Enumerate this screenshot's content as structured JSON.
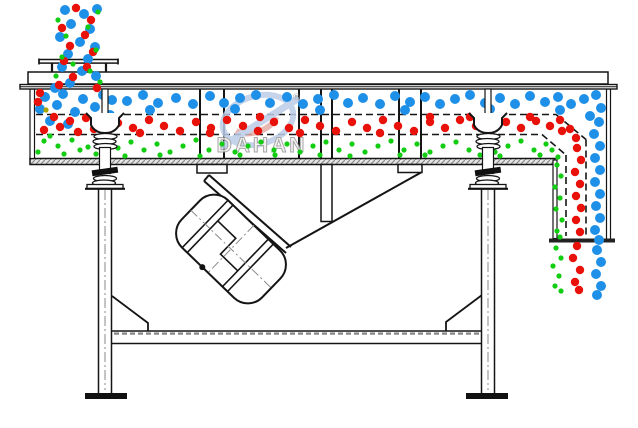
{
  "watermark": {
    "brand": "DAHAN",
    "registered": "®"
  },
  "particles": {
    "colors": {
      "coarse_blue": "#1f90e8",
      "medium_red": "#e8120b",
      "fine_green": "#12cd12",
      "stray_olive": "#a8a400"
    },
    "radii": {
      "coarse_blue": 5,
      "medium_red": 4.2,
      "fine_green": 2.6,
      "stray_olive": 2.6
    },
    "groups": {
      "coarse_blue": [
        [
          65,
          10
        ],
        [
          84,
          14
        ],
        [
          97,
          9
        ],
        [
          71,
          24
        ],
        [
          90,
          29
        ],
        [
          60,
          37
        ],
        [
          80,
          42
        ],
        [
          95,
          47
        ],
        [
          68,
          54
        ],
        [
          88,
          59
        ],
        [
          62,
          67
        ],
        [
          82,
          71
        ],
        [
          96,
          76
        ],
        [
          70,
          83
        ],
        [
          55,
          88
        ],
        [
          45,
          97
        ],
        [
          63,
          94
        ],
        [
          83,
          99
        ],
        [
          103,
          95
        ],
        [
          40,
          109
        ],
        [
          57,
          105
        ],
        [
          75,
          112
        ],
        [
          95,
          107
        ],
        [
          112,
          100
        ],
        [
          50,
          121
        ],
        [
          68,
          124
        ],
        [
          110,
          115
        ],
        [
          127,
          101
        ],
        [
          143,
          95
        ],
        [
          158,
          103
        ],
        [
          176,
          98
        ],
        [
          193,
          104
        ],
        [
          210,
          96
        ],
        [
          224,
          103
        ],
        [
          240,
          98
        ],
        [
          256,
          95
        ],
        [
          270,
          103
        ],
        [
          287,
          97
        ],
        [
          303,
          104
        ],
        [
          318,
          99
        ],
        [
          334,
          95
        ],
        [
          348,
          103
        ],
        [
          363,
          98
        ],
        [
          380,
          104
        ],
        [
          395,
          96
        ],
        [
          410,
          102
        ],
        [
          425,
          97
        ],
        [
          440,
          104
        ],
        [
          455,
          99
        ],
        [
          470,
          95
        ],
        [
          485,
          103
        ],
        [
          500,
          98
        ],
        [
          515,
          104
        ],
        [
          530,
          96
        ],
        [
          545,
          102
        ],
        [
          558,
          97
        ],
        [
          571,
          104
        ],
        [
          584,
          99
        ],
        [
          596,
          95
        ],
        [
          150,
          110
        ],
        [
          235,
          109
        ],
        [
          320,
          110
        ],
        [
          405,
          110
        ],
        [
          490,
          109
        ],
        [
          560,
          110
        ],
        [
          601,
          108
        ],
        [
          590,
          116
        ],
        [
          599,
          122
        ],
        [
          594,
          134
        ],
        [
          600,
          146
        ],
        [
          595,
          158
        ],
        [
          600,
          170
        ],
        [
          595,
          182
        ],
        [
          600,
          194
        ],
        [
          596,
          206
        ],
        [
          600,
          218
        ],
        [
          595,
          230
        ],
        [
          599,
          240
        ],
        [
          597,
          250
        ],
        [
          601,
          262
        ],
        [
          596,
          274
        ],
        [
          601,
          286
        ],
        [
          597,
          295
        ]
      ],
      "medium_red": [
        [
          76,
          8
        ],
        [
          91,
          20
        ],
        [
          62,
          28
        ],
        [
          85,
          35
        ],
        [
          70,
          46
        ],
        [
          93,
          52
        ],
        [
          64,
          61
        ],
        [
          87,
          67
        ],
        [
          73,
          77
        ],
        [
          59,
          85
        ],
        [
          97,
          88
        ],
        [
          38,
          102
        ],
        [
          54,
          117
        ],
        [
          70,
          121
        ],
        [
          86,
          118
        ],
        [
          102,
          124
        ],
        [
          44,
          130
        ],
        [
          60,
          127
        ],
        [
          78,
          132
        ],
        [
          94,
          129
        ],
        [
          108,
          131
        ],
        [
          40,
          93
        ],
        [
          118,
          123
        ],
        [
          133,
          128
        ],
        [
          149,
          120
        ],
        [
          164,
          126
        ],
        [
          180,
          131
        ],
        [
          196,
          122
        ],
        [
          211,
          128
        ],
        [
          227,
          120
        ],
        [
          243,
          126
        ],
        [
          258,
          131
        ],
        [
          274,
          122
        ],
        [
          289,
          128
        ],
        [
          305,
          120
        ],
        [
          320,
          126
        ],
        [
          336,
          131
        ],
        [
          352,
          122
        ],
        [
          367,
          128
        ],
        [
          383,
          120
        ],
        [
          398,
          126
        ],
        [
          414,
          131
        ],
        [
          430,
          122
        ],
        [
          445,
          128
        ],
        [
          460,
          120
        ],
        [
          476,
          126
        ],
        [
          491,
          131
        ],
        [
          506,
          122
        ],
        [
          521,
          128
        ],
        [
          536,
          121
        ],
        [
          550,
          126
        ],
        [
          562,
          131
        ],
        [
          140,
          133
        ],
        [
          260,
          117
        ],
        [
          380,
          133
        ],
        [
          300,
          133
        ],
        [
          470,
          117
        ],
        [
          210,
          133
        ],
        [
          430,
          117
        ],
        [
          530,
          117
        ],
        [
          560,
          120
        ],
        [
          570,
          129
        ],
        [
          576,
          138
        ],
        [
          577,
          148
        ],
        [
          581,
          160
        ],
        [
          575,
          172
        ],
        [
          580,
          184
        ],
        [
          576,
          196
        ],
        [
          581,
          208
        ],
        [
          576,
          220
        ],
        [
          580,
          232
        ],
        [
          577,
          246
        ],
        [
          573,
          258
        ],
        [
          580,
          270
        ],
        [
          575,
          282
        ],
        [
          579,
          290
        ]
      ],
      "fine_green": [
        [
          98,
          12
        ],
        [
          58,
          20
        ],
        [
          88,
          27
        ],
        [
          66,
          36
        ],
        [
          96,
          50
        ],
        [
          62,
          57
        ],
        [
          90,
          71
        ],
        [
          73,
          64
        ],
        [
          100,
          82
        ],
        [
          56,
          76
        ],
        [
          44,
          141
        ],
        [
          58,
          146
        ],
        [
          72,
          140
        ],
        [
          88,
          147
        ],
        [
          102,
          142
        ],
        [
          38,
          152
        ],
        [
          64,
          154
        ],
        [
          80,
          150
        ],
        [
          96,
          154
        ],
        [
          110,
          146
        ],
        [
          50,
          136
        ],
        [
          118,
          148
        ],
        [
          131,
          142
        ],
        [
          144,
          150
        ],
        [
          157,
          144
        ],
        [
          170,
          152
        ],
        [
          183,
          146
        ],
        [
          196,
          140
        ],
        [
          209,
          150
        ],
        [
          222,
          144
        ],
        [
          235,
          152
        ],
        [
          248,
          146
        ],
        [
          261,
          142
        ],
        [
          274,
          150
        ],
        [
          287,
          144
        ],
        [
          300,
          152
        ],
        [
          313,
          146
        ],
        [
          326,
          142
        ],
        [
          339,
          150
        ],
        [
          352,
          144
        ],
        [
          365,
          152
        ],
        [
          378,
          146
        ],
        [
          391,
          141
        ],
        [
          404,
          150
        ],
        [
          417,
          144
        ],
        [
          430,
          152
        ],
        [
          443,
          146
        ],
        [
          456,
          142
        ],
        [
          469,
          150
        ],
        [
          482,
          144
        ],
        [
          495,
          152
        ],
        [
          508,
          146
        ],
        [
          521,
          141
        ],
        [
          534,
          150
        ],
        [
          546,
          144
        ],
        [
          125,
          156
        ],
        [
          200,
          156
        ],
        [
          275,
          155
        ],
        [
          350,
          156
        ],
        [
          425,
          155
        ],
        [
          500,
          156
        ],
        [
          540,
          155
        ],
        [
          160,
          155
        ],
        [
          240,
          155
        ],
        [
          320,
          155
        ],
        [
          400,
          155
        ],
        [
          480,
          155
        ],
        [
          552,
          150
        ],
        [
          558,
          157
        ],
        [
          557,
          165
        ],
        [
          561,
          176
        ],
        [
          555,
          187
        ],
        [
          560,
          198
        ],
        [
          556,
          209
        ],
        [
          562,
          220
        ],
        [
          557,
          231
        ],
        [
          560,
          237
        ],
        [
          556,
          248
        ],
        [
          561,
          258
        ],
        [
          553,
          266
        ],
        [
          559,
          276
        ],
        [
          555,
          286
        ],
        [
          561,
          291
        ]
      ],
      "stray_olive": [
        [
          46,
          110
        ]
      ]
    }
  }
}
